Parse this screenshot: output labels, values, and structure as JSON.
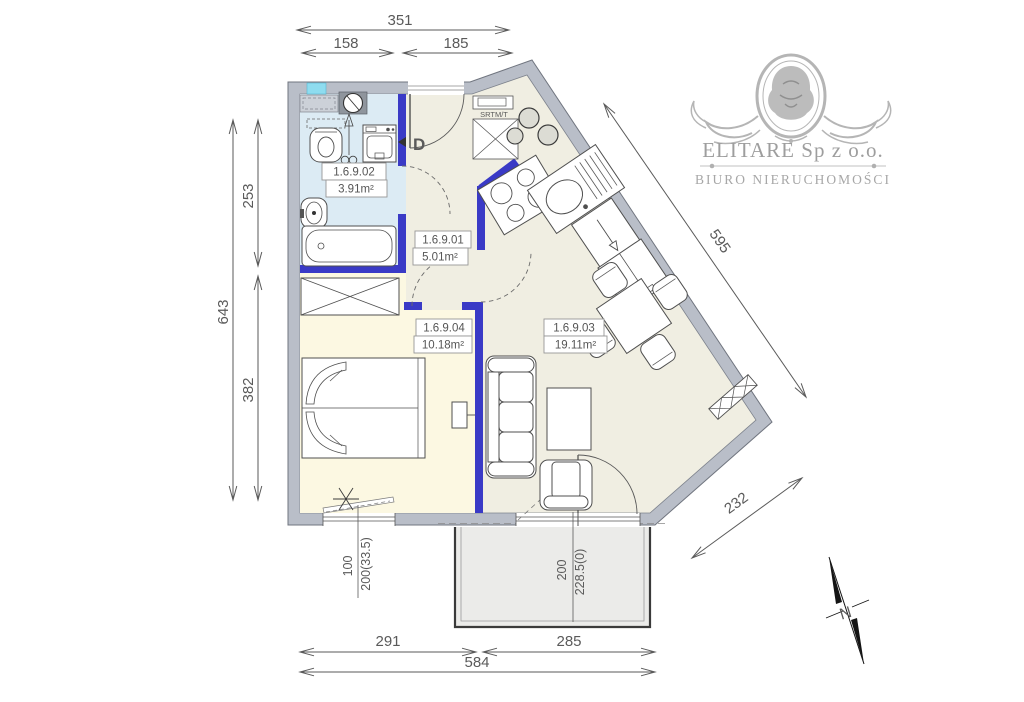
{
  "canvas": {
    "width": 1024,
    "height": 702,
    "background": "#ffffff"
  },
  "branding": {
    "company": "ELITARE Sp z o.o.",
    "tagline": "BIURO NIERUCHOMOŚCI"
  },
  "compass": {
    "north_label": "N"
  },
  "plan": {
    "entrance_label": "D",
    "shaft_label": "SRTM/T",
    "rooms": [
      {
        "number": "1.6.9.01",
        "area": "5.01m²"
      },
      {
        "number": "1.6.9.02",
        "area": "3.91m²"
      },
      {
        "number": "1.6.9.03",
        "area": "19.11m²"
      },
      {
        "number": "1.6.9.04",
        "area": "10.18m²"
      }
    ]
  },
  "dimensions": {
    "top_total": "351",
    "top_left": "158",
    "top_right": "185",
    "left_total": "643",
    "left_upper": "253",
    "left_lower": "382",
    "diag_upper": "595",
    "diag_lower": "232",
    "bottom_left": "291",
    "bottom_right": "285",
    "bottom_total": "584",
    "bedroom_window_width": "100",
    "bedroom_window_params": "200(33.5)",
    "balcony_door_width": "200",
    "balcony_door_params": "228.5(0)"
  },
  "colors": {
    "exterior_wall": "#b9bec8",
    "partition_wall": "#3a3ac6",
    "bathroom_floor": "#dcebf4",
    "bedroom_floor": "#fcf8e2",
    "living_floor": "#f0eee2",
    "balcony_floor": "#ebebe9",
    "window_accent": "#8edcef",
    "dimension_ink": "#5a5a5a",
    "logo_gray": "#adadad"
  }
}
